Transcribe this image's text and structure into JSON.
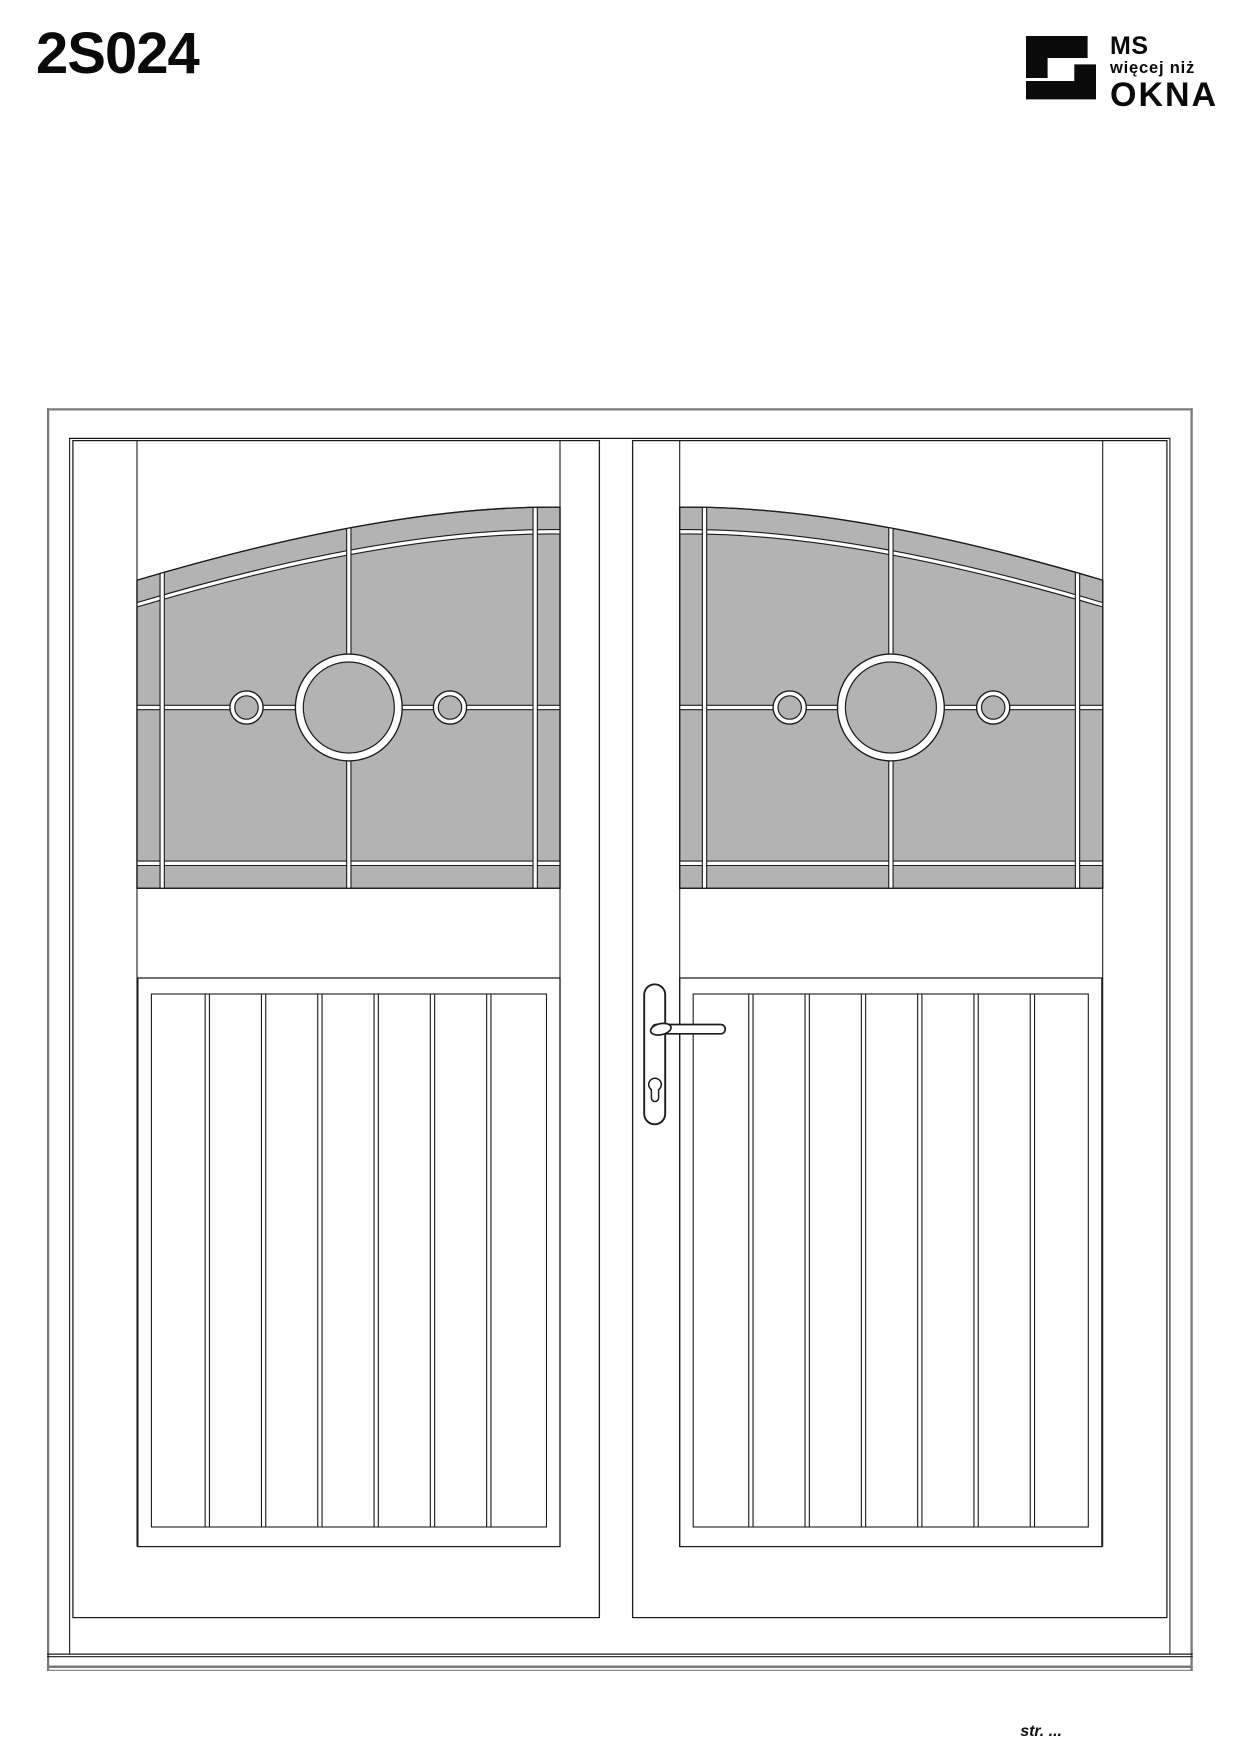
{
  "page": {
    "title": "2S024",
    "footer": "str. ..."
  },
  "logo": {
    "line1": "MS",
    "line2": "więcej niż",
    "line3": "OKNA",
    "mark": "ms-okna-square-s-mark"
  },
  "drawing": {
    "name": "double-door-technical-drawing",
    "product_code": "2S024",
    "leaf_count": 2,
    "glazing": "arched stained-glass panel with border muntins, center muntin, horizontal muntin and three circle ornaments per leaf",
    "circles_per_leaf": 3,
    "planks_per_leaf": 7,
    "handle": "lever handle with euro profile cylinder on right leaf",
    "colors": {
      "glass_fill": "#b3b3b3",
      "line": "#1c1c1c",
      "outer_frame_line": "#7a7a7a",
      "background": "#ffffff"
    }
  }
}
